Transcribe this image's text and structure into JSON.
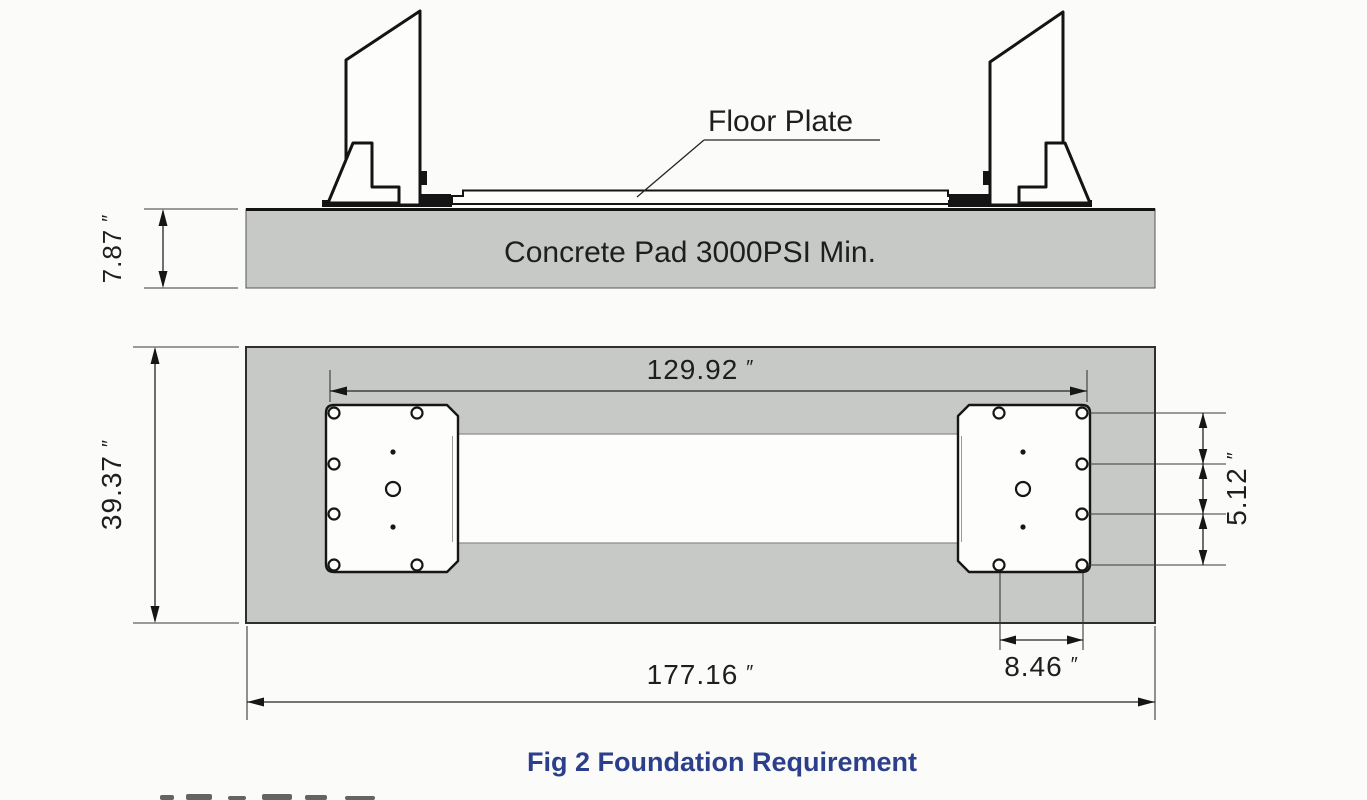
{
  "figure": {
    "caption": "Fig 2 Foundation Requirement",
    "side_view": {
      "floor_plate_label": "Floor Plate",
      "concrete_pad_label": "Concrete Pad 3000PSI Min.",
      "pad_thickness": {
        "value": "7.87",
        "unit": "″"
      }
    },
    "plan_view": {
      "bolt_span_width": {
        "value": "129.92",
        "unit": "″"
      },
      "pad_depth": {
        "value": "39.37",
        "unit": "″"
      },
      "bolt_row_spacing": {
        "value": "5.12",
        "unit": "″"
      },
      "bolt_pair_spacing": {
        "value": "8.46",
        "unit": "″"
      },
      "pad_overall_width": {
        "value": "177.16",
        "unit": "″"
      }
    },
    "colors": {
      "pad_fill": "#c7c9c6",
      "drawing_line": "#161616",
      "caption_text": "#2b3f8c",
      "background": "#fbfbf9",
      "plate_fill": "#fdfdfc"
    }
  }
}
